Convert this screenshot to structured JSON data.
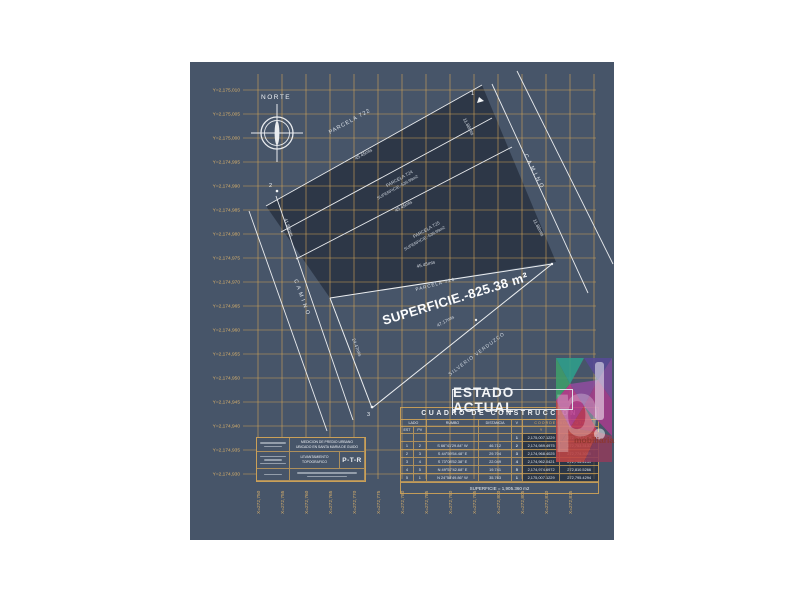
{
  "canvas": {
    "bg": "#475569",
    "dark_overlay": "#2b3544",
    "grid_color": "#d8a857",
    "label_color": "#d9b06a",
    "line_color": "#f2f4f6"
  },
  "axes": {
    "y_labels": [
      "Y=2,175,010",
      "Y=2,175,005",
      "Y=2,175,000",
      "Y=2,174,995",
      "Y=2,174,990",
      "Y=2,174,985",
      "Y=2,174,980",
      "Y=2,174,975",
      "Y=2,174,970",
      "Y=2,174,965",
      "Y=2,174,960",
      "Y=2,174,955",
      "Y=2,174,950",
      "Y=2,174,945",
      "Y=2,174,940",
      "Y=2,174,935",
      "Y=2,174,930"
    ],
    "x_labels": [
      "X=272,750",
      "X=272,755",
      "X=272,760",
      "X=272,765",
      "X=272,770",
      "X=272,775",
      "X=272,780",
      "X=272,785",
      "X=272,790",
      "X=272,795",
      "X=272,800",
      "X=272,805",
      "X=272,810",
      "X=272,815"
    ]
  },
  "plan": {
    "north_label": "NORTE",
    "parcel_722": "PARCELA 722",
    "parcel_724_name": "PARCELA 724",
    "parcel_724_area": "SUPERFICIE.-539.99m2",
    "parcel_725_name": "PARCELA 725",
    "parcel_725_area": "SUPERFICIE.-539.99m2",
    "parcel_726_name": "PARCELA 726",
    "parcel_726_area": "SUPERFICIE.-825.38 m²",
    "dim_722_724": "45.45mts",
    "dim_724_725": "45.45mts",
    "dim_726_top": "45.45mts",
    "dim_726_diagonal": "47.17mts",
    "dim_726_left": "24.47mts",
    "dim_right_upper": "11.88mts",
    "dim_right_lower": "11.88mts",
    "dim_left_road": "41.88mts",
    "road_right": "CAMINO",
    "road_left": "CAMINO",
    "neighbor_owner": "SILVERIO VERDUZCO",
    "vertex_1": "1",
    "vertex_2": "2",
    "vertex_3": "3",
    "status_label": "ESTADO ACTUAL"
  },
  "table": {
    "title": "CUADRO DE CONSTRUCCION",
    "col_lado": "LADO",
    "col_est": "EST",
    "col_pv": "PV",
    "col_rumbo": "RUMBO",
    "col_distancia": "DISTANCIA",
    "col_v": "V",
    "col_coords": "COORDENADAS UTM",
    "col_y": "Y",
    "col_x": "X",
    "rows": [
      {
        "est": "",
        "pv": "",
        "rumbo": "",
        "dist": "",
        "v": "1",
        "y": "2,175,007.1229",
        "x": "272,795.4294"
      },
      {
        "est": "1",
        "pv": "2",
        "rumbo": "S 66°41'29.84\" W",
        "dist": "46.712",
        "v": "2",
        "y": "2,174,989.4975",
        "x": "272,753.3137"
      },
      {
        "est": "2",
        "pv": "3",
        "rumbo": "S 44°59'54.48\" E",
        "dist": "29.704",
        "v": "3",
        "y": "2,174,968.4025",
        "x": "272,774.3065"
      },
      {
        "est": "3",
        "pv": "4",
        "rumbo": "S 73°08'52.38\" E",
        "dist": "22.049",
        "v": "4",
        "y": "2,174,962.0421",
        "x": "272,795.4139"
      },
      {
        "est": "4",
        "pv": "5",
        "rumbo": "N 49°57'42.68\" E",
        "dist": "19.741",
        "v": "5",
        "y": "2,174,974.6972",
        "x": "272,810.5266"
      },
      {
        "est": "5",
        "pv": "1",
        "rumbo": "N 24°58'49.86\" W",
        "dist": "35.763",
        "v": "1",
        "y": "2,175,007.1229",
        "x": "272,795.4294"
      }
    ],
    "footer": "SUPERFICIE = 1,905.360 m2"
  },
  "title_block": {
    "project_line1": "MEDICION DE PREDIO URBANO",
    "project_line2": "UBICADO EN SANTA MARIA DE GUIDO",
    "work_line1": "LEVANTAMIENTO",
    "work_line2": "TOPOGRAFICO",
    "logo": "P-T-R"
  },
  "watermark": {
    "letter": "p",
    "bang": "!",
    "brand": "mobiliaria",
    "colors": [
      "#2fa08c",
      "#564a96",
      "#3e9e6b",
      "#7c4d9c",
      "#8e4d9e",
      "#b93c8c",
      "#c04545",
      "#a53c8c",
      "#c2385a",
      "#8e3c5c"
    ]
  }
}
